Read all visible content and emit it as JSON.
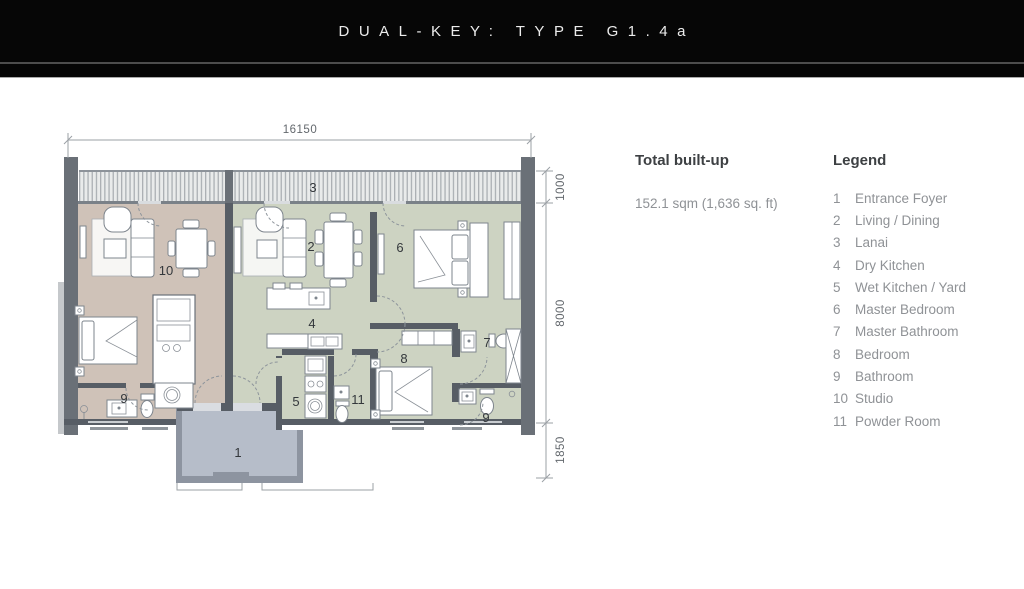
{
  "header": {
    "title": "DUAL-KEY: TYPE G1.4a"
  },
  "summary": {
    "built_up_label": "Total built-up",
    "built_up_value": "152.1 sqm (1,636 sq. ft)"
  },
  "legend": {
    "title": "Legend",
    "items": [
      {
        "num": "1",
        "label": "Entrance Foyer"
      },
      {
        "num": "2",
        "label": "Living / Dining"
      },
      {
        "num": "3",
        "label": "Lanai"
      },
      {
        "num": "4",
        "label": "Dry Kitchen"
      },
      {
        "num": "5",
        "label": "Wet Kitchen / Yard"
      },
      {
        "num": "6",
        "label": "Master Bedroom"
      },
      {
        "num": "7",
        "label": "Master Bathroom"
      },
      {
        "num": "8",
        "label": "Bedroom"
      },
      {
        "num": "9",
        "label": "Bathroom"
      },
      {
        "num": "10",
        "label": "Studio"
      },
      {
        "num": "11",
        "label": "Powder Room"
      }
    ]
  },
  "plan": {
    "dims": {
      "top": "16150",
      "lanai_depth": "1000",
      "body_depth": "8000",
      "lower_depth": "1850"
    },
    "labels": {
      "foyer": "1",
      "living": "2",
      "lanai": "3",
      "dry_kitchen": "4",
      "wet_kitchen": "5",
      "master_bedroom": "6",
      "master_bathroom": "7",
      "bedroom": "8",
      "bathroom_left": "9",
      "bathroom_right": "9",
      "studio": "10",
      "powder": "11"
    },
    "colors": {
      "studio_fill": "#cfc2b8",
      "unit_fill": "#cdd3c2",
      "foyer_fill": "#b6bdc9",
      "wall": "#575d65"
    }
  }
}
